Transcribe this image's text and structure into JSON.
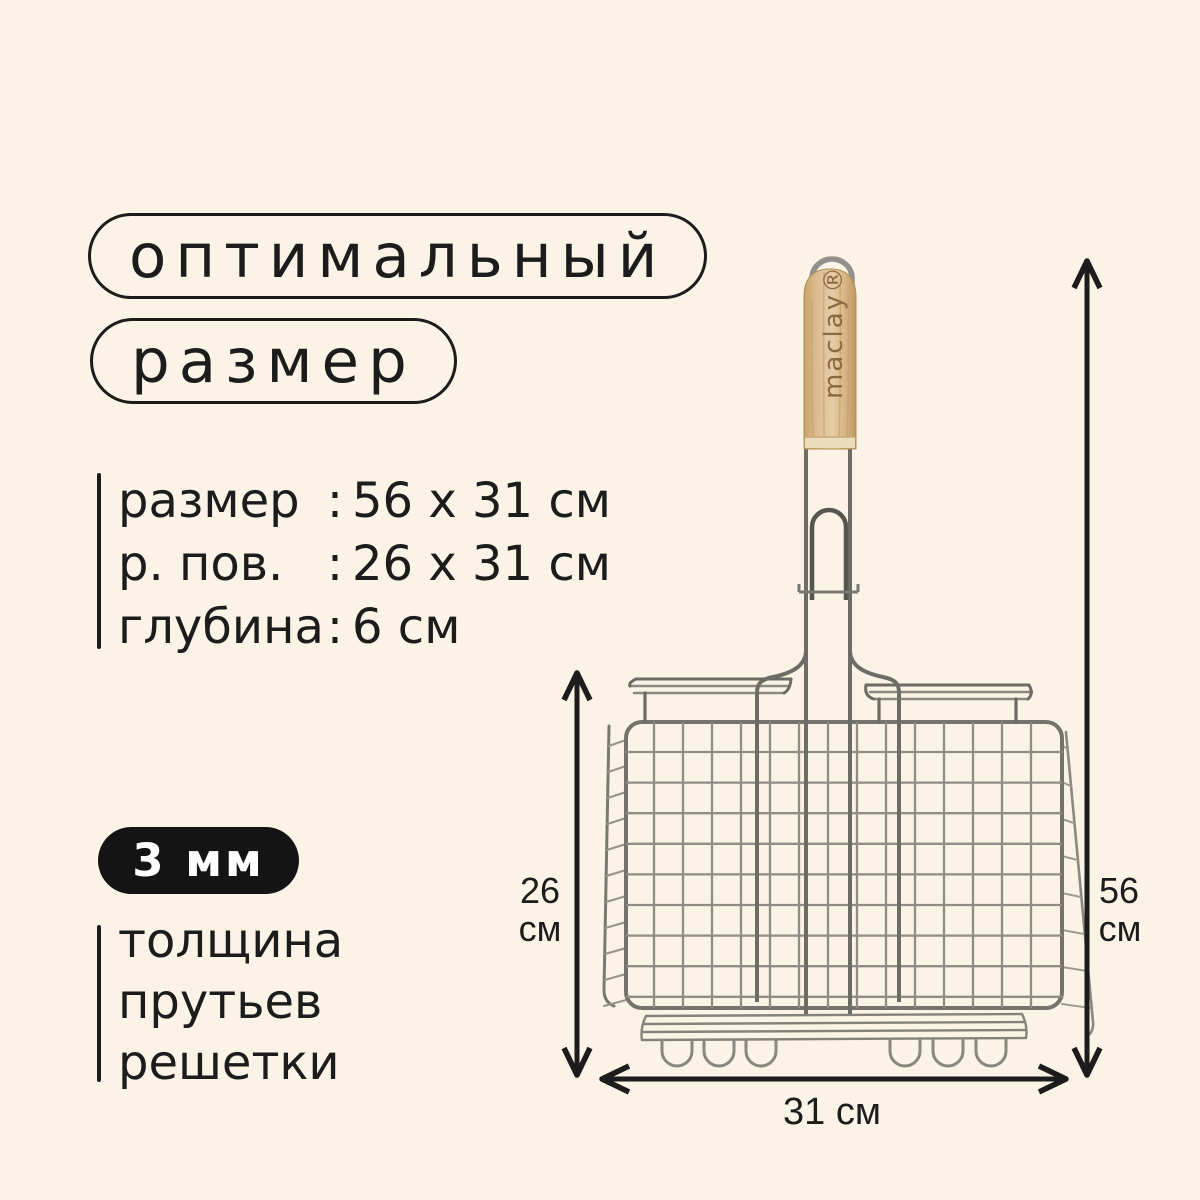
{
  "header": {
    "pill1": "оптимальный",
    "pill2": "размер"
  },
  "specs": {
    "rows": [
      {
        "label": "размер",
        "colon": ":",
        "value": "56 x 31 см"
      },
      {
        "label": "р. пов.",
        "colon": ":",
        "value": "26 x 31 см"
      },
      {
        "label": "глубина",
        "colon": ":",
        "value": "6 см"
      }
    ]
  },
  "badge": {
    "text": "3 мм"
  },
  "feature": {
    "lines": [
      "толщина",
      "прутьев",
      "решетки"
    ]
  },
  "product": {
    "brand": "maclay®"
  },
  "dimensions": {
    "total_height": {
      "value": "56",
      "unit": "см"
    },
    "grate_height": {
      "value": "26",
      "unit": "см"
    },
    "width": {
      "label": "31 см"
    }
  },
  "colors": {
    "background": "#FBF3E5",
    "text": "#1C1C1C",
    "badge_background": "#141414",
    "badge_text": "#FFFFFF",
    "wood": "#DDBE92",
    "brand_text": "#8A6A42",
    "chrome": "#8B8984",
    "arrow": "#1C1C1C"
  }
}
